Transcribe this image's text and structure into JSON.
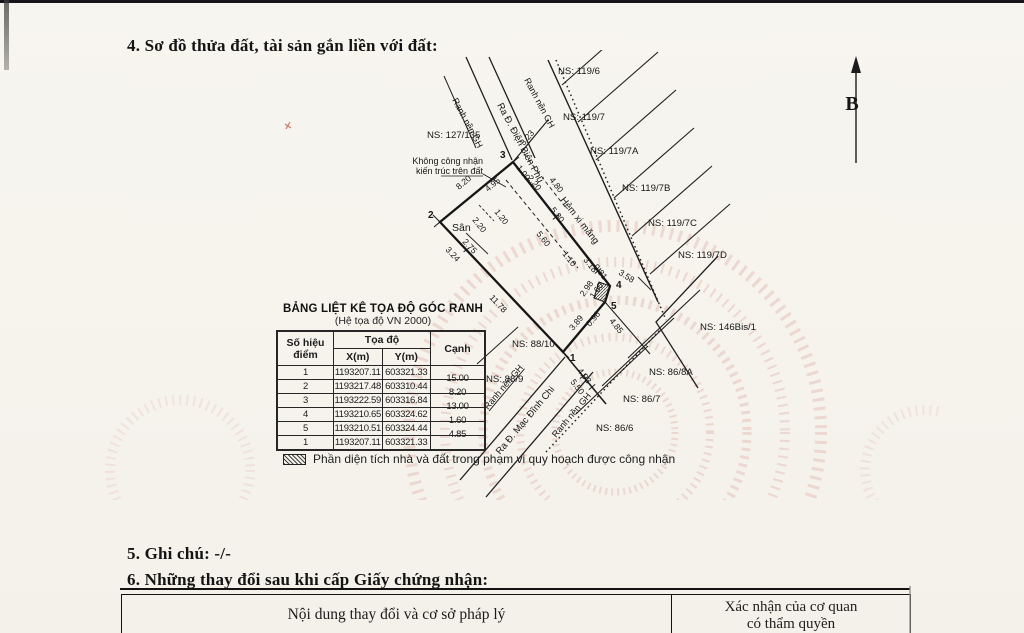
{
  "page": {
    "section4_title": "4. Sơ đồ thửa đất, tài sản gắn liền với đất:",
    "section5_title": "5. Ghi chú: -/-",
    "section6_title": "6. Những thay đổi sau khi cấp Giấy chứng nhận:"
  },
  "diagram": {
    "north_label": "B",
    "area_label": "Sân",
    "note_line1": "Không công nhận",
    "note_line2": "kiến trúc trên đất",
    "boundary_label": "Ranh nền GH",
    "roads": {
      "dien_bien_phu": "Ra Đ. Điện Biên Phủ",
      "alley": "Hẻm xi măng",
      "mac_dinh_chi": "Ra Đ. Mạc Đĩnh Chi"
    },
    "points": [
      "1",
      "2",
      "3",
      "4",
      "5"
    ],
    "neighbors": [
      "NS: 127/135",
      "NS: 119/6",
      "NS: 119/7",
      "NS: 119/7A",
      "NS: 119/7B",
      "NS: 119/7C",
      "NS: 119/7D",
      "NS: 146Bis/1",
      "NS: 88/10",
      "NS: 88/9",
      "NS: 86/8A",
      "NS: 86/7",
      "NS: 86/6"
    ],
    "measurements": [
      "3.23",
      "1.00",
      "2.20",
      "4.80",
      "8.20",
      "4.95",
      "1.20",
      "2.20",
      "2.75",
      "3.24",
      "11.78",
      "5.80",
      "5.60",
      "1.10",
      "3.18",
      "0.81",
      "3.58",
      "2.98",
      "1.60",
      "3.89",
      "0.96",
      "4.85",
      "4.93",
      "5.50"
    ]
  },
  "coordinate_table": {
    "title": "BẢNG LIỆT KÊ TỌA ĐỘ GÓC RANH",
    "subtitle": "(Hệ tọa độ VN 2000)",
    "col_point_l1": "Số hiệu",
    "col_point_l2": "điểm",
    "col_coord": "Tọa độ",
    "col_x": "X(m)",
    "col_y": "Y(m)",
    "col_edge": "Cạnh",
    "rows": [
      {
        "p": "1",
        "x": "1193207.11",
        "y": "603321.33",
        "c": "15.00"
      },
      {
        "p": "2",
        "x": "1193217.48",
        "y": "603310.44",
        "c": "8.20"
      },
      {
        "p": "3",
        "x": "1193222.59",
        "y": "603316.84",
        "c": "13.00"
      },
      {
        "p": "4",
        "x": "1193210.65",
        "y": "603324.62",
        "c": "1.60"
      },
      {
        "p": "5",
        "x": "1193210.51",
        "y": "603324.44",
        "c": "4.85"
      },
      {
        "p": "1",
        "x": "1193207.11",
        "y": "603321.33",
        "c": ""
      }
    ]
  },
  "legend": {
    "text": "Phần diện tích nhà và đất trong phạm vi quy hoạch được công nhận"
  },
  "changes_table": {
    "col1": "Nội dung thay đổi và cơ sở pháp lý",
    "col2_l1": "Xác nhận của cơ quan",
    "col2_l2": "có thẩm quyền"
  }
}
